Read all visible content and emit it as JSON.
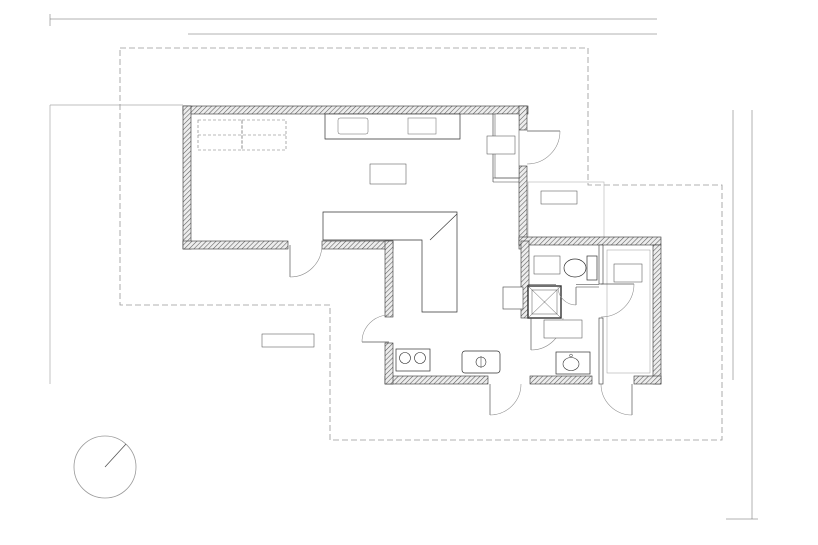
{
  "drawing": {
    "rooms": {
      "ldk": {
        "name": "LDK",
        "area": "43.1m²"
      },
      "entrance": {
        "name": "玄関",
        "area": "1.6m²"
      },
      "porch": {
        "name": "ポーチ"
      },
      "wc": {
        "name": "WC",
        "area": "1.0m²"
      },
      "washroom": {
        "name": "洗面所",
        "area": "4.3m²"
      },
      "bedroom": {
        "name": "寝室",
        "area": "6.6m²"
      },
      "wood_deck": {
        "name": "ウッドデッキ"
      }
    },
    "dimensions": {
      "top_left_offset": "3,640",
      "top_total": "12,740",
      "top_spans": [
        "1,820",
        "1,820",
        "1,820",
        "1,820",
        "1,820",
        "1,820",
        "1,820"
      ],
      "right_total": "7,280",
      "right_spans": [
        "1,820",
        "1,820",
        "1,820",
        "1,820"
      ],
      "right_lower": "3,640"
    },
    "grid": {
      "x_axis": [
        "X1",
        "X2",
        "X3",
        "X4",
        "X5",
        "X6",
        "X7",
        "X8"
      ],
      "y_axis": [
        "Y1",
        "Y2",
        "Y3",
        "Y4",
        "Y5"
      ]
    },
    "compass": {
      "label": "N"
    }
  }
}
